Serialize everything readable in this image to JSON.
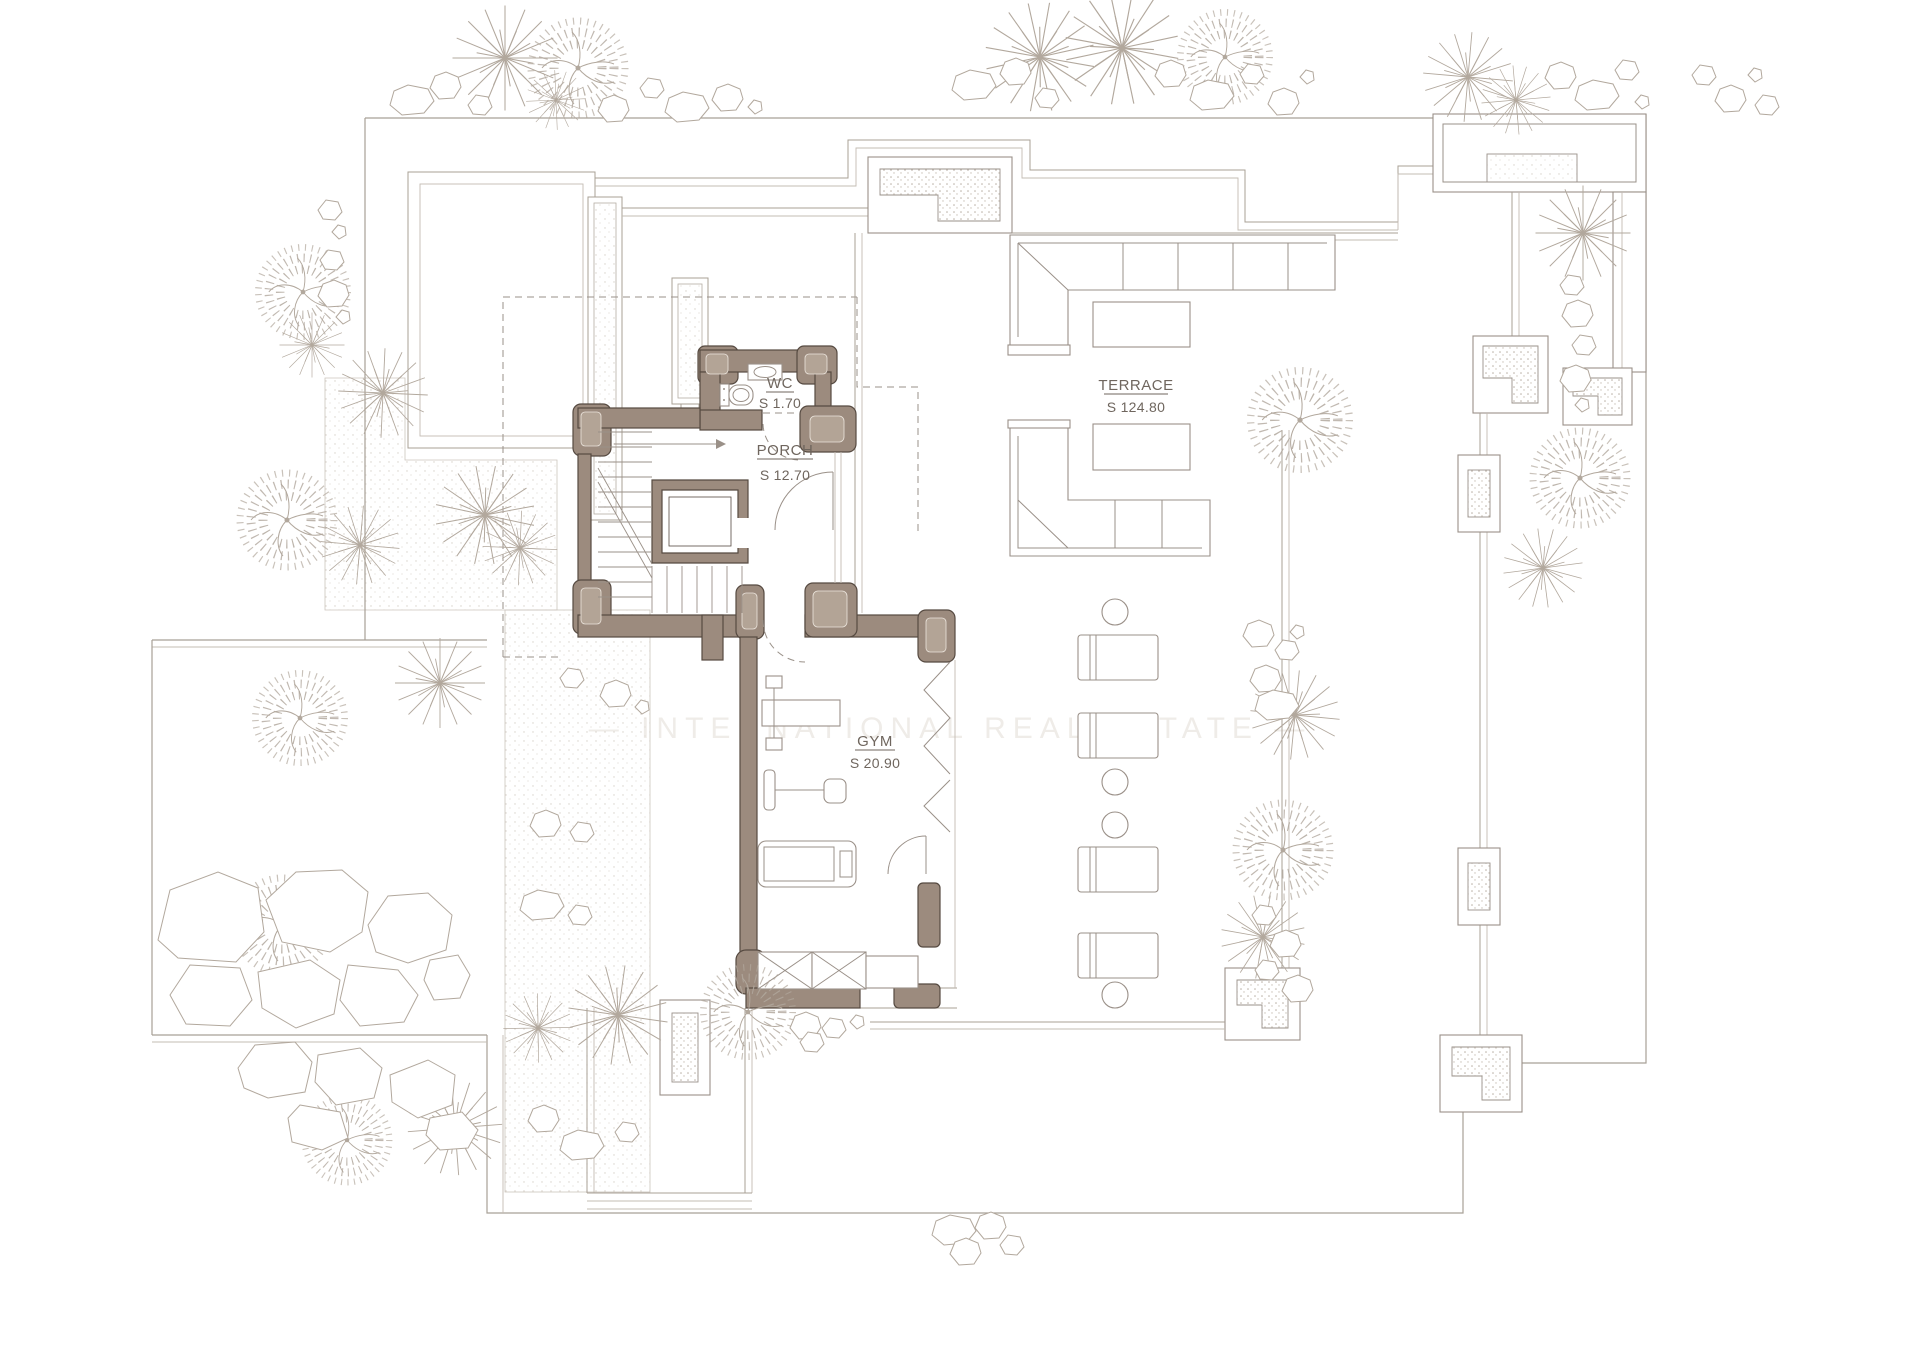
{
  "watermark": {
    "text": "— INTERNATIONAL REAL ESTATE —"
  },
  "rooms": {
    "wc": {
      "name": "WC",
      "area": "S 1.70"
    },
    "porch": {
      "name": "PORCH",
      "area": "S 12.70"
    },
    "gym": {
      "name": "GYM",
      "area": "S 20.90"
    },
    "terrace": {
      "name": "TERRACE",
      "area": "S 124.80"
    }
  },
  "colors": {
    "background": "#ffffff",
    "wall_fill": "#9c8b7e",
    "wall_stroke": "#564a41",
    "pillar_inner": "#b3a496",
    "line": "#a8a096",
    "line_light": "#c3bcb3",
    "vegetation": "#b2a89d",
    "label_text": "#6f665e",
    "watermark": "#efece8",
    "stipple": "#c6beb4"
  }
}
